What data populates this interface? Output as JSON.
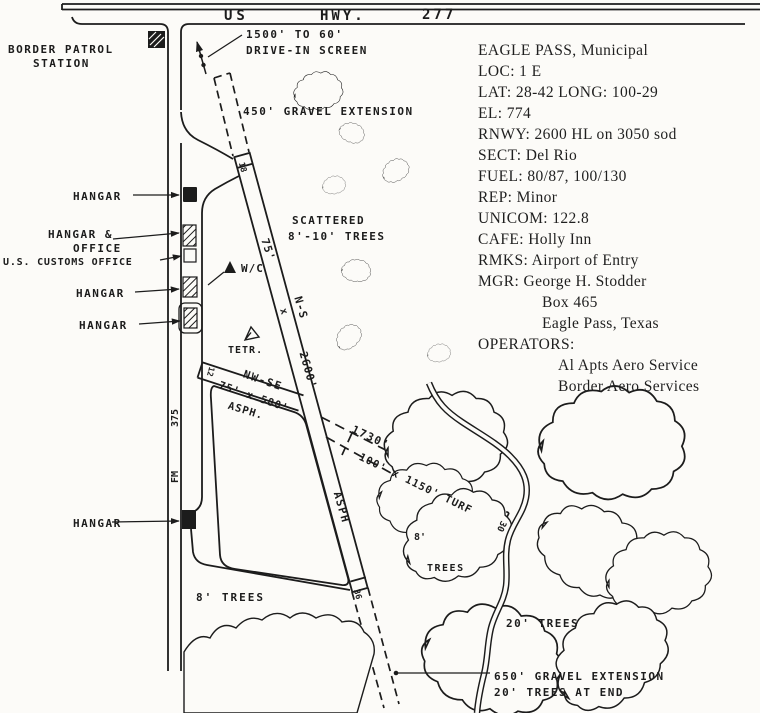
{
  "info_panel": {
    "lines": [
      "EAGLE PASS, Municipal",
      "LOC: 1 E",
      "LAT: 28-42 LONG: 100-29",
      "EL: 774",
      "RNWY: 2600 HL on 3050 sod",
      "SECT: Del Rio",
      "FUEL: 80/87, 100/130",
      "REP: Minor",
      "UNICOM: 122.8",
      "CAFE: Holly Inn",
      "RMKS: Airport of Entry",
      "MGR: George H. Stodder",
      "Box 465",
      "Eagle Pass, Texas",
      "OPERATORS:",
      "Al Apts Aero Service",
      "Border Aero Services"
    ]
  },
  "map": {
    "labels": {
      "us": "US",
      "hwy": "HWY.",
      "n277": "277",
      "border_patrol_1": "BORDER PATROL",
      "border_patrol_2": "STATION",
      "drive_in_1": "1500' TO 60'",
      "drive_in_2": "DRIVE-IN SCREEN",
      "gravel_450": "450' GRAVEL EXTENSION",
      "scattered_1": "SCATTERED",
      "scattered_2": "8'-10' TREES",
      "hangar_top": "HANGAR",
      "hangar_office_1": "HANGAR &",
      "hangar_office_2": "OFFICE",
      "customs": "U.S. CUSTOMS OFFICE",
      "hangar_mid1": "HANGAR",
      "hangar_mid2": "HANGAR",
      "hangar_bottom": "HANGAR",
      "wc": "W/C",
      "tetr": "TETR.",
      "rwy_ns_width": "75'",
      "rwy_ns_x": "x",
      "rwy_ns_name": "N-S",
      "rwy_ns_len": "2600'",
      "rwy_ns_surface": "ASPH",
      "rwy_ns_num_n": "18",
      "rwy_ns_num_s": "36",
      "rwy_nwse_name": "NW-SE",
      "rwy_nwse_dims": "75' x 580'",
      "rwy_nwse_surface": "ASPH.",
      "rwy_nwse_num": "12",
      "turf_total": "1730'",
      "turf_dims": "100' x 1150' TURF",
      "turf_num": "30",
      "fm": "FM",
      "n375": "375",
      "trees_8_left": "8' TREES",
      "trees_8_mid_a": "8'",
      "trees_8_mid_b": "TREES",
      "trees_20": "20' TREES",
      "gravel_650": "650' GRAVEL EXTENSION",
      "trees_end": "20' TREES AT END"
    }
  },
  "colors": {
    "ink": "#1c1c1c",
    "paper": "#fcfbf8"
  }
}
